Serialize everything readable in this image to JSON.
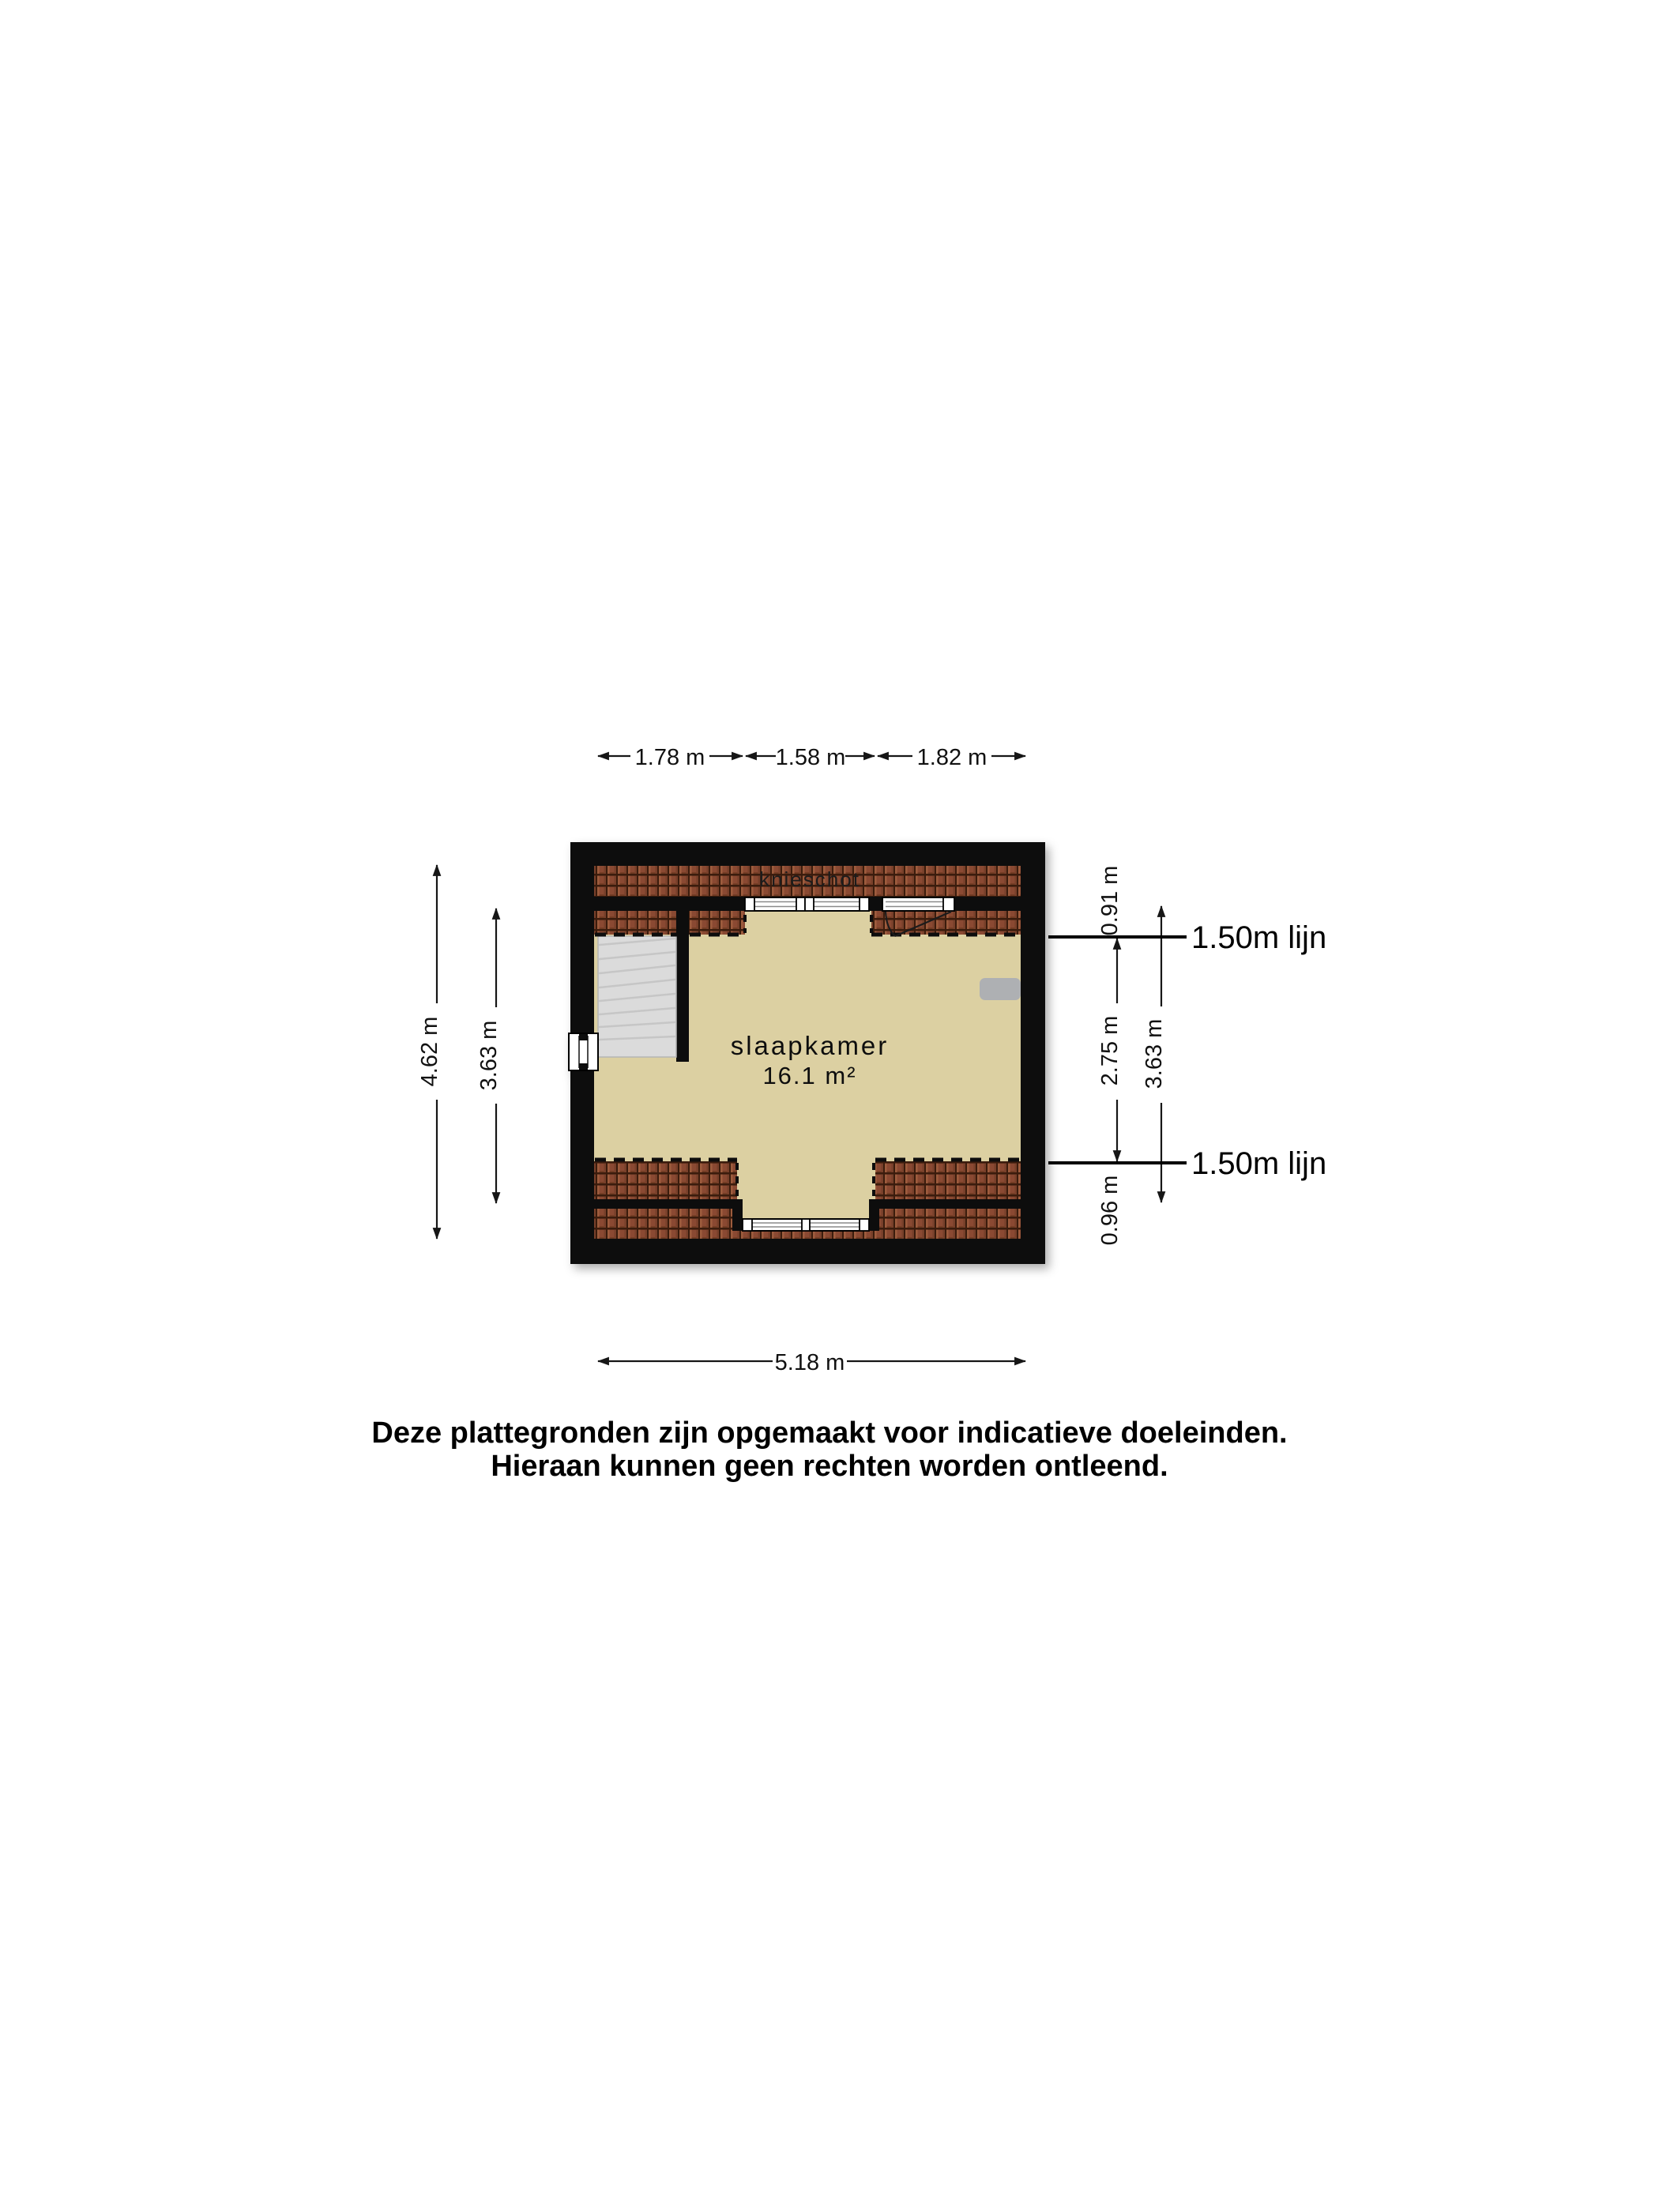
{
  "floorplan": {
    "room": {
      "name": "slaapkamer",
      "area": "16.1 m²"
    },
    "knieschot_label": "knieschot",
    "knee_lines": {
      "label_top": "1.50m lijn",
      "label_bottom": "1.50m lijn"
    },
    "dimensions": {
      "top": [
        "1.78 m",
        "1.58 m",
        "1.82 m"
      ],
      "bottom": "5.18 m",
      "left_outer": "4.62 m",
      "left_inner": "3.63 m",
      "right_top": "0.91 m",
      "right_middle": "2.75 m",
      "right_inner": "3.63 m",
      "right_bottom": "0.96 m"
    },
    "colors": {
      "floor": "#dcd0a2",
      "tile": "#8a4a33",
      "tile_dark": "#3a1d10",
      "wall": "#0b0b0b",
      "stair": "#dbdbdb",
      "radiator": "#aeb0b3"
    }
  },
  "disclaimer": {
    "line1": "Deze plattegronden zijn opgemaakt voor indicatieve doeleinden.",
    "line2": "Hieraan kunnen geen rechten worden ontleend."
  }
}
